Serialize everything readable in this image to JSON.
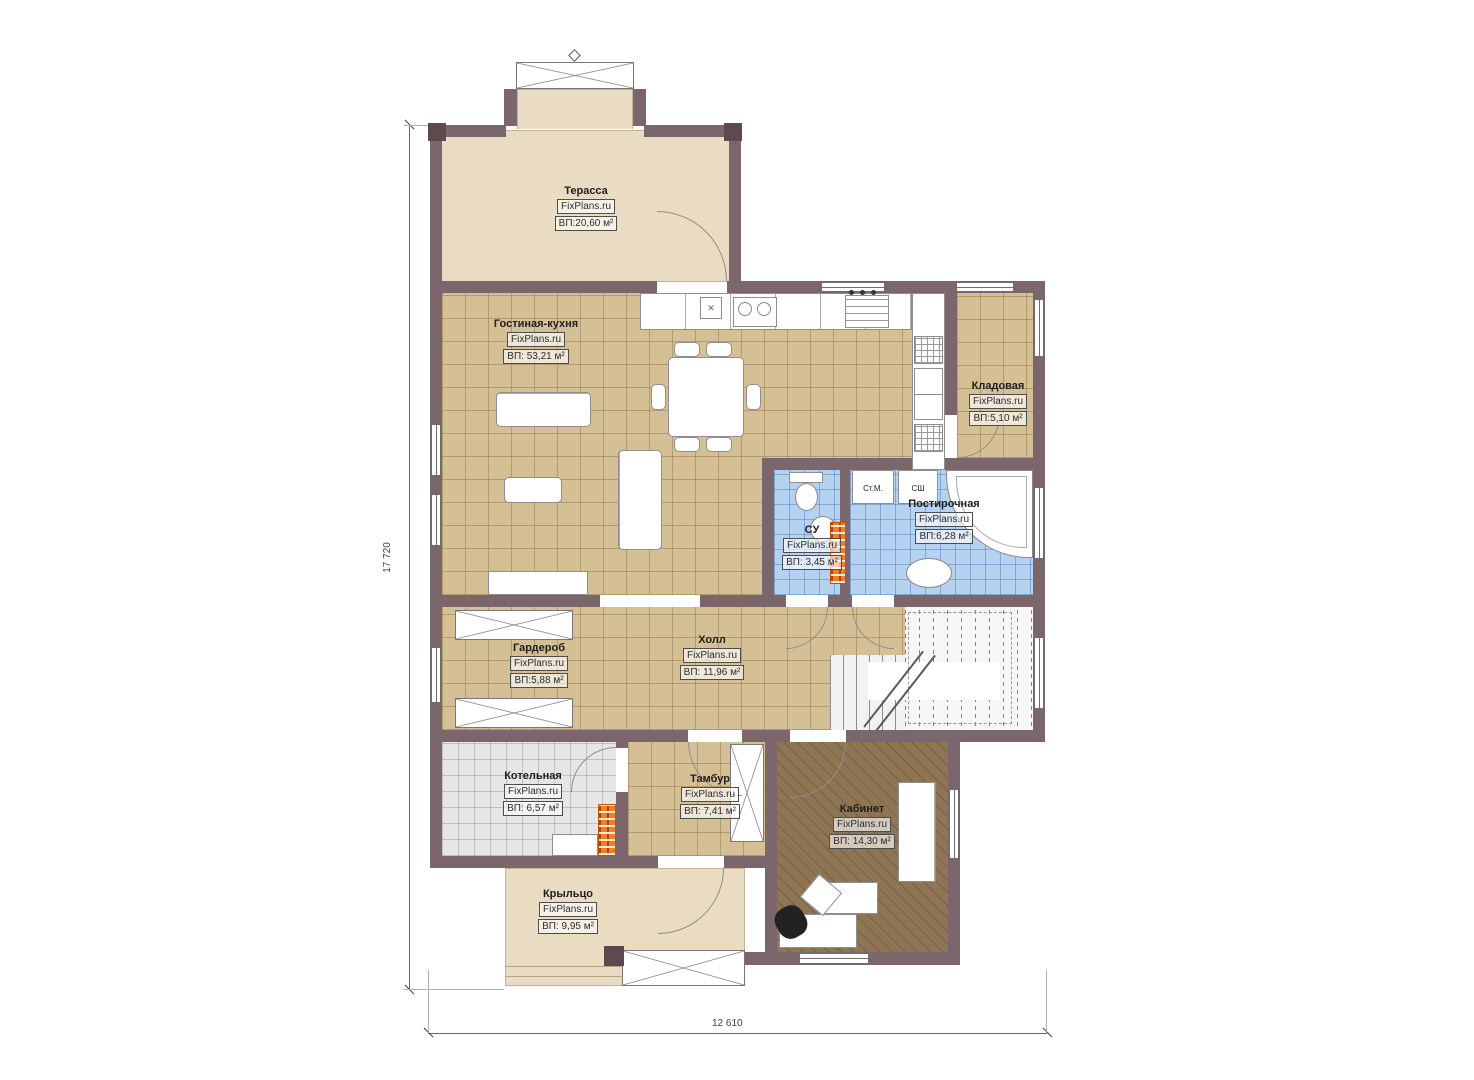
{
  "plan": {
    "source": "FixPlans.ru",
    "dimensions": {
      "width": "12 610",
      "height": "17 720"
    },
    "rooms": [
      {
        "name": "Терасса",
        "brand": "FixPlans.ru",
        "area": "ВП:20,60 м²"
      },
      {
        "name": "Гостиная-кухня",
        "brand": "FixPlans.ru",
        "area": "ВП: 53,21 м²"
      },
      {
        "name": "Кладовая",
        "brand": "FixPlans.ru",
        "area": "ВП:5,10 м²"
      },
      {
        "name": "СУ",
        "brand": "FixPlans.ru",
        "area": "ВП: 3,45 м²"
      },
      {
        "name": "Постирочная",
        "brand": "FixPlans.ru",
        "area": "ВП:6,28 м²"
      },
      {
        "name": "Холл",
        "brand": "FixPlans.ru",
        "area": "ВП: 11,96 м²"
      },
      {
        "name": "Гардероб",
        "brand": "FixPlans.ru",
        "area": "ВП:5,88 м²"
      },
      {
        "name": "Котельная",
        "brand": "FixPlans.ru",
        "area": "ВП: 6,57 м²"
      },
      {
        "name": "Тамбур",
        "brand": "FixPlans.ru",
        "area": "ВП: 7,41 м²"
      },
      {
        "name": "Кабинет",
        "brand": "FixPlans.ru",
        "area": "ВП: 14,30 м²"
      },
      {
        "name": "Крыльцо",
        "brand": "FixPlans.ru",
        "area": "ВП: 9,95 м²"
      }
    ],
    "appliance_labels": {
      "washing_machine": "Ст.М.",
      "dryer": "СШ"
    },
    "colors": {
      "wall": "#7b666b",
      "wall_post": "#5d4a4f",
      "tile_tan": "#d5c096",
      "tile_blue": "#b5d2f1",
      "tile_gray": "#e6e6e6",
      "wood": "#8e7554",
      "terrace_beige": "#e9dcc3",
      "accent_orange": "#ef7d2a"
    }
  }
}
